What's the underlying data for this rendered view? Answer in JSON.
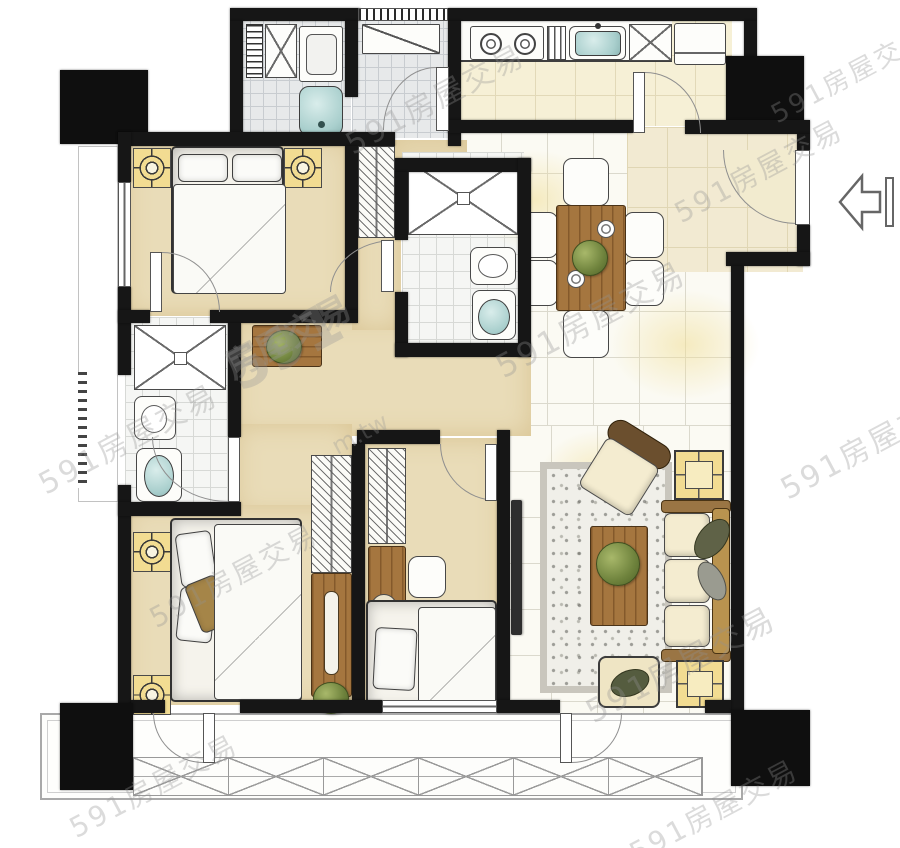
{
  "watermark": {
    "brand": "591",
    "suffix": "房屋交易",
    "full": "591房屋交易",
    "site": "m.tw"
  },
  "palette": {
    "wall": "#161616",
    "floor_tan": "#e9dcb8",
    "floor_tile_white": "#fbfaf3",
    "floor_mosaic_grey": "#e7e9ea",
    "floor_kitchen": "#f6f0d6",
    "floor_foyer": "#f2ead2",
    "wood": "#a5763f",
    "fixture_teal": "#a9cfcd",
    "accent_yellow": "#f2dc92",
    "sofa_cream": "#f4ecd0",
    "plant_green": "#6f833d",
    "door_arc_grey": "#8f8f8f"
  },
  "floorplan": {
    "type": "apartment-floor-plan",
    "style": "hand-drawn watercolor",
    "entrance": {
      "side": "right",
      "arrow_direction": "left"
    },
    "rooms": [
      {
        "name": "laundry-bathroom-top-left",
        "floor": "grey-mosaic-tile",
        "fixtures": [
          "storage-ladder-shelf",
          "x-cabinet",
          "washing-machine",
          "bathtub"
        ]
      },
      {
        "name": "utility-vestibule",
        "floor": "grey-mosaic-tile",
        "fixtures": [
          "counter",
          "swing-door",
          "striped-window"
        ]
      },
      {
        "name": "kitchen",
        "floor": "cream-tile",
        "fixtures": [
          "two-burner-stove",
          "drainboard",
          "sink",
          "x-cabinet",
          "refrigerator",
          "swing-door"
        ]
      },
      {
        "name": "entry-foyer",
        "floor": "beige-tile",
        "fixtures": [
          "entry-door",
          "entry-arrow"
        ]
      },
      {
        "name": "dining-area",
        "floor": "white-tile-grid",
        "fixtures": [
          "wood-dining-table",
          "six-chairs",
          "plant-centerpiece",
          "two-place-settings"
        ]
      },
      {
        "name": "bedroom-1-top-left",
        "floor": "tan-wash",
        "fixtures": [
          "double-bed",
          "two-pillows",
          "two-nightstand-lamps",
          "hatched-closet",
          "window-west",
          "swing-door"
        ]
      },
      {
        "name": "guest-bathroom-center",
        "floor": "white-tile",
        "fixtures": [
          "x-shower",
          "washbasin",
          "toilet",
          "swing-door"
        ]
      },
      {
        "name": "hallway",
        "floor": "tan-wash",
        "fixtures": [
          "wood-console-sideboard",
          "plant"
        ]
      },
      {
        "name": "master-bathroom-left",
        "floor": "white-tile",
        "fixtures": [
          "x-shower",
          "washbasin",
          "toilet",
          "swing-door",
          "louver-vent"
        ]
      },
      {
        "name": "master-bedroom-bottom-left",
        "floor": "tan-wash",
        "fixtures": [
          "double-bed",
          "accent-pillow",
          "two-nightstand-lamps",
          "hatched-wardrobe",
          "dresser-with-slot",
          "plant",
          "balcony-door"
        ]
      },
      {
        "name": "bedroom-2-bottom-center",
        "floor": "tan-wash",
        "fixtures": [
          "single-bed",
          "desk",
          "stool",
          "hatched-wardrobe",
          "nightstand",
          "south-window",
          "swing-door"
        ]
      },
      {
        "name": "living-room-bottom-right",
        "floor": "white-tile-grid",
        "fixtures": [
          "three-seat-sofa",
          "two-throw-pillows",
          "armchair",
          "wood-coffee-table",
          "plant",
          "pebble-rug",
          "two-side-tables",
          "ottoman",
          "wall-tv",
          "balcony-door"
        ]
      },
      {
        "name": "balcony-bottom",
        "floor": "white",
        "fixtures": [
          "x-lattice-planter",
          "two-swing-doors"
        ]
      }
    ],
    "structure": [
      "four-black-corner-columns",
      "black-walls",
      "white-exterior"
    ]
  }
}
